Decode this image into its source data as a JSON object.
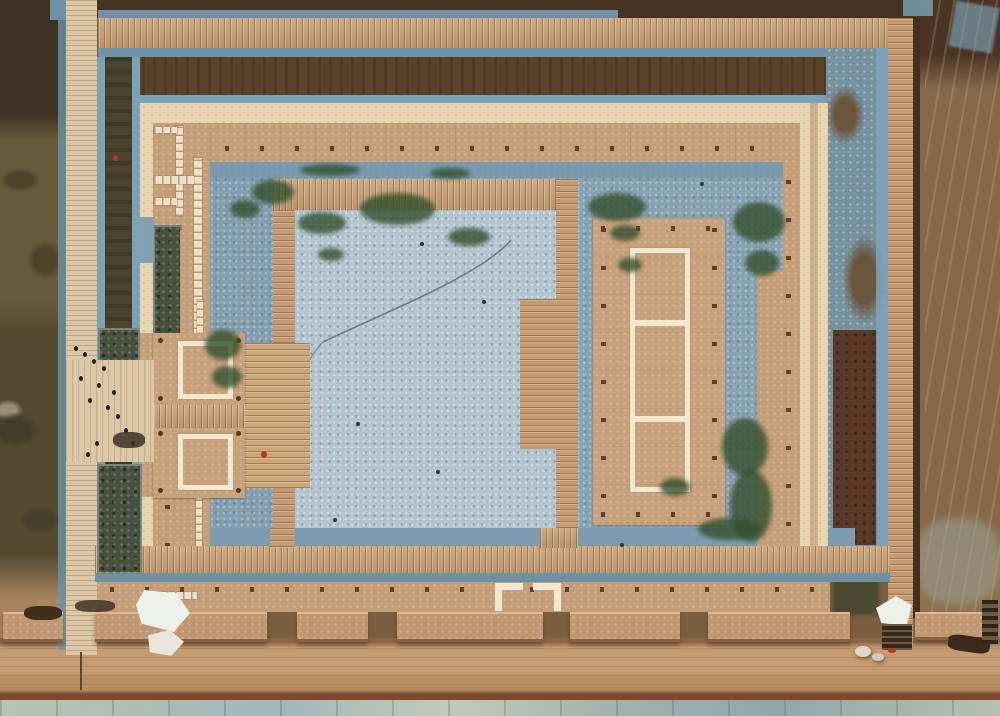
{
  "meta": {
    "description": "Drone aerial photograph of an excavated archaeological palace-foundation site: a rectangular rammed-earth enclosure with gate platforms, an eastern hall foundation outlined in white, blue-gray gravel conservation fill, wooden visitor boardwalks on all four sides, a row of wall blocks along the south edge, a dirt road and stone kerb strip at the bottom; no text is visible in the image",
    "type": "aerial-photograph"
  },
  "palette": {
    "field_dark_brown": "#46331f",
    "field_brown": "#86684a",
    "field_olive": "#5f5036",
    "berm_brown": "#5a422b",
    "berm_olive": "#4b432e",
    "gravel_blue": "#7ba3b8",
    "gravel_blue_dark": "#6f8fa2",
    "courtyard_blue": "#8fa9b8",
    "courtyard_blue_light": "#b1c4cf",
    "boardwalk_wood": "#c8a176",
    "boardwalk_pale": "#dcc8a7",
    "wall_tan": "#c49e78",
    "wall_pale_edge": "#e8d5b2",
    "foundation_white": "#f2e8d2",
    "vegetation_green": "#33502e",
    "pit_dark": "#49503c",
    "road_tan": "#b78d62",
    "kerb_gray_green": "#aebdb4",
    "marker_red": "#c03424"
  },
  "regions": {
    "enclosure": "rectangular rammed-earth enclosure wall with post-hole dots",
    "east_hall": "eastern hall platform with three-cell white foundation outline",
    "west_gate": "west gate with two square white-outlined foundations",
    "courtyard": "blue gravel covered courtyards",
    "boardwalks": "wooden visitor boardwalks around and inside the enclosure",
    "south_wall_blocks": "row of reconstructed wall blocks along south side",
    "visitors": "group of visitors on west entrance platform",
    "tents": "white tarpaulin tents at south-west and south-east",
    "road": "dirt service road along the bottom",
    "kerb": "pale stone slab strip at bottom edge"
  }
}
